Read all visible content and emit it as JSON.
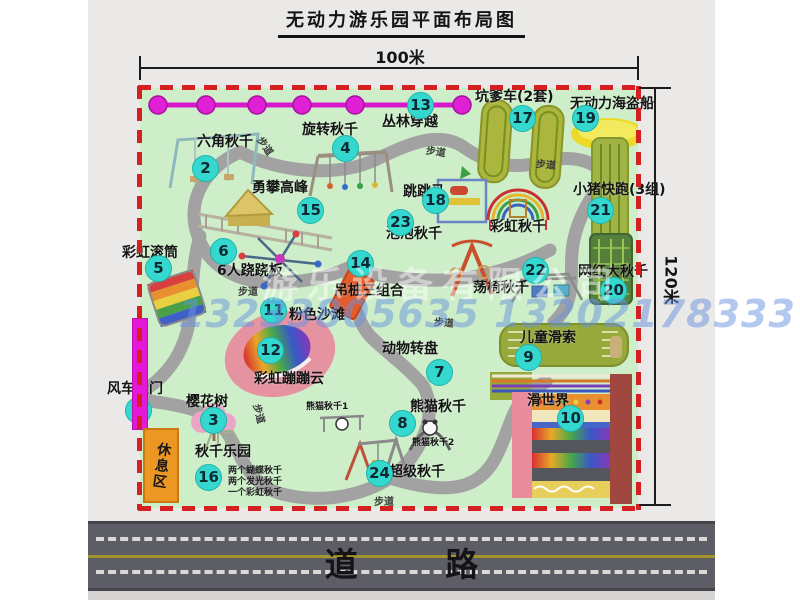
{
  "title": "无动力游乐园平面布局图",
  "dimensions": {
    "width_label": "100米",
    "height_label": "120米"
  },
  "road": {
    "label": "道 路"
  },
  "watermark": {
    "company": "游乐设备有限公司",
    "phone": "13233805635 13202178333"
  },
  "rest_area": {
    "label": "休息区"
  },
  "colors": {
    "map_green": "#cdeec9",
    "path_gray": "#a2a2a2",
    "badge_teal": "#35d8cf",
    "border_red": "#d42020",
    "road_gray": "#5d5d65",
    "gate_magenta": "#e318d8",
    "zipline_magenta": "#d818cc",
    "rest_orange": "#ec9723"
  },
  "attractions": [
    {
      "num": "1",
      "label": "风车大门",
      "badge": [
        -2,
        322
      ],
      "label_pos": [
        -33,
        294
      ]
    },
    {
      "num": "2",
      "label": "六角秋千",
      "badge": [
        65,
        80
      ],
      "label_pos": [
        57,
        47
      ]
    },
    {
      "num": "3",
      "label": "樱花树",
      "badge": [
        73,
        332
      ],
      "label_pos": [
        46,
        307
      ]
    },
    {
      "num": "4",
      "label": "旋转秋千",
      "badge": [
        205,
        60
      ],
      "label_pos": [
        162,
        35
      ]
    },
    {
      "num": "5",
      "label": "彩虹滚筒",
      "badge": [
        18,
        180
      ],
      "label_pos": [
        -18,
        158
      ]
    },
    {
      "num": "6",
      "label": "6人跷跷板",
      "badge": [
        83,
        163
      ],
      "label_pos": [
        77,
        176
      ]
    },
    {
      "num": "7",
      "label": "动物转盘",
      "badge": [
        299,
        284
      ],
      "label_pos": [
        242,
        254
      ]
    },
    {
      "num": "8",
      "label": "熊猫秋千",
      "badge": [
        262,
        335
      ],
      "label_pos": [
        270,
        312
      ]
    },
    {
      "num": "9",
      "label": "儿童滑索",
      "badge": [
        388,
        269
      ],
      "label_pos": [
        380,
        243
      ]
    },
    {
      "num": "10",
      "label": "滑世界",
      "badge": [
        430,
        330
      ],
      "label_pos": [
        387,
        306
      ]
    },
    {
      "num": "11",
      "label": "粉色沙滩",
      "badge": [
        133,
        222
      ],
      "label_pos": [
        149,
        220
      ]
    },
    {
      "num": "12",
      "label": "彩虹蹦蹦云",
      "badge": [
        130,
        262
      ],
      "label_pos": [
        114,
        284
      ]
    },
    {
      "num": "13",
      "label": "丛林穿越",
      "badge": [
        280,
        17
      ],
      "label_pos": [
        242,
        27
      ]
    },
    {
      "num": "14",
      "label": "吊桩三组合",
      "badge": [
        220,
        175
      ],
      "label_pos": [
        194,
        196
      ]
    },
    {
      "num": "15",
      "label": "勇攀高峰",
      "badge": [
        170,
        122
      ],
      "label_pos": [
        112,
        93
      ]
    },
    {
      "num": "16",
      "label": "秋千乐园",
      "badge": [
        68,
        389
      ],
      "label_pos": [
        55,
        357
      ],
      "sub_lines": [
        "两个蝴蝶秋千",
        "两个发光秋千",
        "一个彩虹秋千"
      ],
      "sub_pos": [
        88,
        378
      ]
    },
    {
      "num": "17",
      "label": "坑爹车(2套)",
      "badge": [
        382,
        30
      ],
      "label_pos": [
        335,
        2
      ]
    },
    {
      "num": "18",
      "label": "跳跳马",
      "badge": [
        295,
        112
      ],
      "label_pos": [
        263,
        97
      ]
    },
    {
      "num": "19",
      "label": "无动力海盗船",
      "badge": [
        445,
        30
      ],
      "label_pos": [
        430,
        9
      ]
    },
    {
      "num": "20",
      "label": "网红大秋千",
      "badge": [
        473,
        202
      ],
      "label_pos": [
        438,
        177
      ]
    },
    {
      "num": "21",
      "label": "小猪快跑(3组)",
      "badge": [
        460,
        122
      ],
      "label_pos": [
        433,
        95
      ]
    },
    {
      "num": "22",
      "label": "荡椅秋千",
      "badge": [
        395,
        182
      ],
      "label_pos": [
        333,
        193
      ]
    },
    {
      "num": "23",
      "label": "泡泡秋千",
      "badge": [
        260,
        134
      ],
      "label_pos": [
        246,
        139
      ]
    },
    {
      "num": "24",
      "label": "超级秋千",
      "badge": [
        239,
        385
      ],
      "label_pos": [
        249,
        377
      ]
    },
    {
      "num": null,
      "label": "彩虹秋千",
      "badge": null,
      "label_pos": [
        350,
        132
      ]
    },
    {
      "num": null,
      "label": "熊猫秋千1",
      "badge": null,
      "label_pos": [
        166,
        315
      ],
      "small": true
    },
    {
      "num": null,
      "label": "熊猫秋千2",
      "badge": null,
      "label_pos": [
        272,
        351
      ],
      "small": true
    }
  ],
  "path_labels": [
    {
      "text": "步道",
      "pos": [
        116,
        50
      ],
      "rot": 55
    },
    {
      "text": "步道",
      "pos": [
        286,
        55
      ],
      "rot": 8
    },
    {
      "text": "步道",
      "pos": [
        396,
        68
      ],
      "rot": 5
    },
    {
      "text": "步道",
      "pos": [
        98,
        195
      ],
      "rot": 0
    },
    {
      "text": "步道",
      "pos": [
        294,
        226
      ],
      "rot": 5
    },
    {
      "text": "步道",
      "pos": [
        110,
        318
      ],
      "rot": 75
    },
    {
      "text": "步道",
      "pos": [
        234,
        405
      ],
      "rot": 0
    }
  ]
}
